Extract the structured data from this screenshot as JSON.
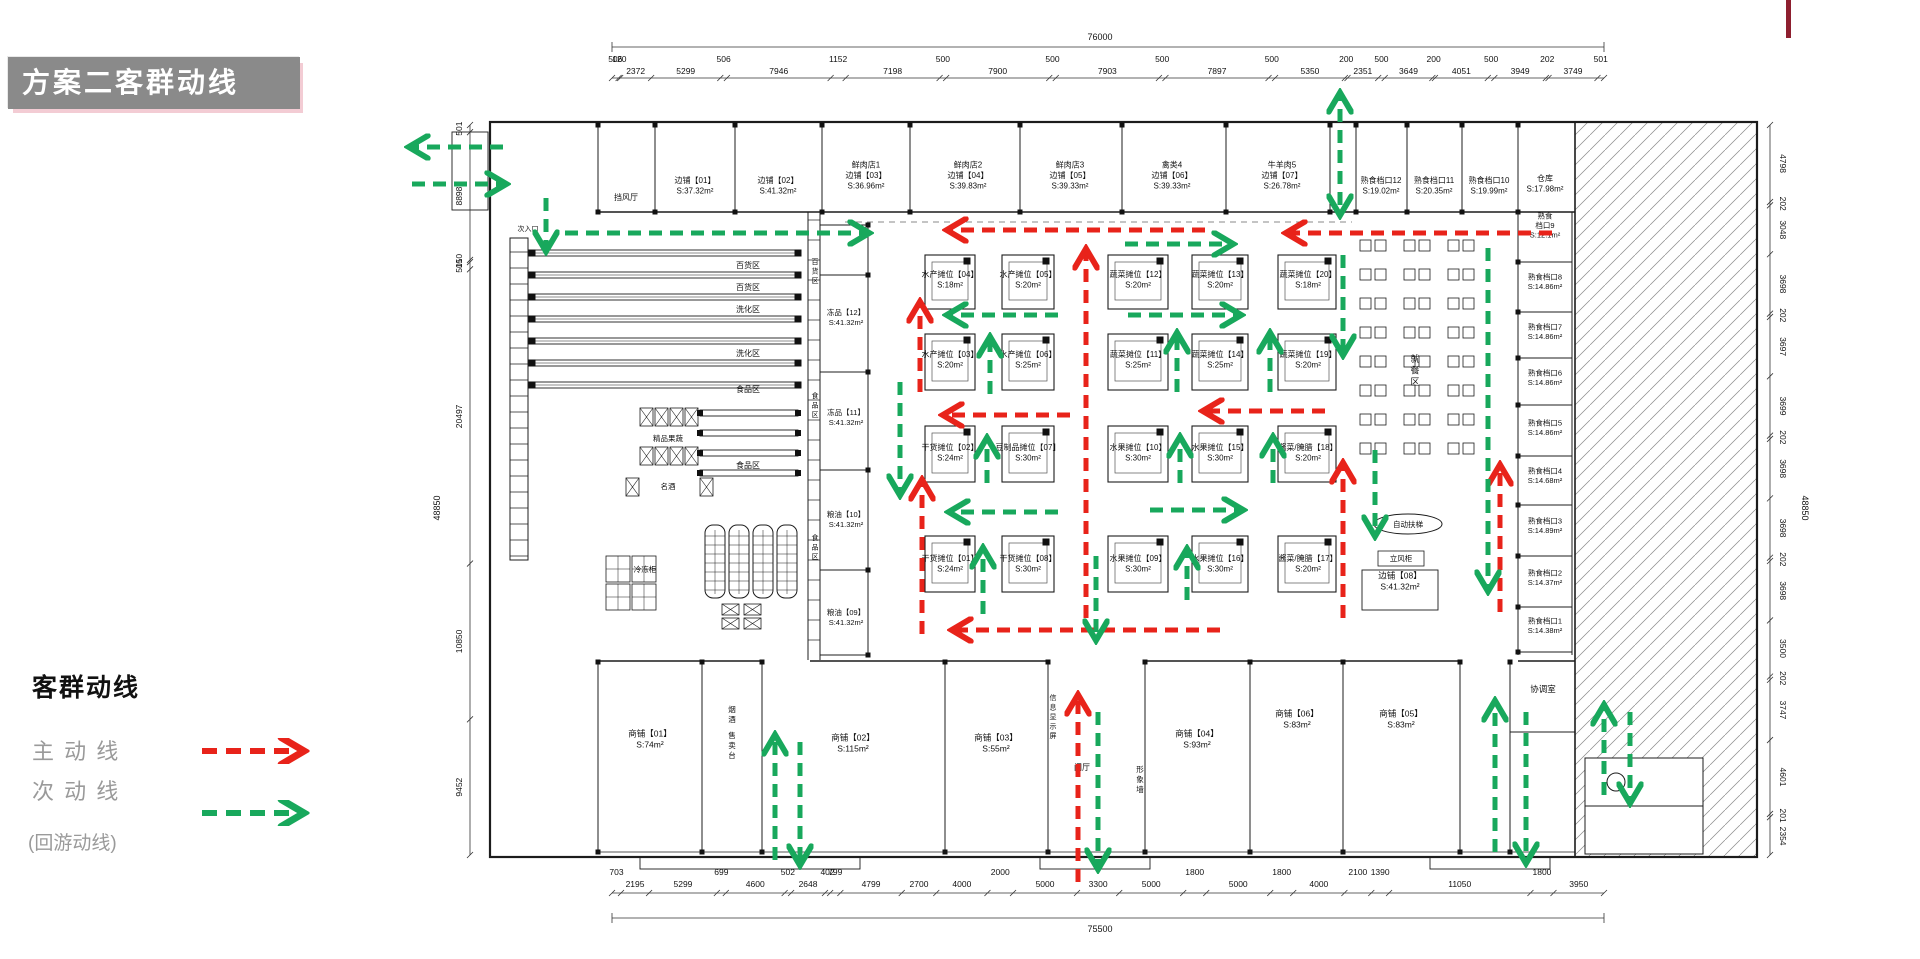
{
  "page": {
    "title": "方案二客群动线",
    "accent_red": "#e8231a",
    "accent_green": "#18a85c",
    "corner_mark_color": "#8e1f2f"
  },
  "legend": {
    "heading": "客群动线",
    "main_label": "主 动 线",
    "secondary_label": "次 动 线",
    "note_label": "(回游动线)"
  },
  "dimensions": {
    "top": {
      "total": "76000",
      "segments": [
        "506",
        "120",
        "2372",
        "5299",
        "506",
        "7946",
        "1152",
        "7198",
        "500",
        "7900",
        "500",
        "7903",
        "500",
        "7897",
        "500",
        "5350",
        "200",
        "2351",
        "500",
        "3649",
        "200",
        "4051",
        "500",
        "3949",
        "202",
        "3749",
        "501"
      ]
    },
    "bottom": {
      "total": "75500",
      "segments": [
        "703",
        "2195",
        "5299",
        "699",
        "4600",
        "502",
        "2648",
        "402",
        "799",
        "4799",
        "2700",
        "4000",
        "2000",
        "5000",
        "3300",
        "5000",
        "1800",
        "5000",
        "1800",
        "4000",
        "2100",
        "1390",
        "11050",
        "1800",
        "3950"
      ]
    },
    "left": {
      "total": "48850",
      "segments": [
        "501",
        "8898",
        "150",
        "501",
        "20497",
        "10850",
        "9452"
      ]
    },
    "right": {
      "total": "48850",
      "segments": [
        "4798",
        "202",
        "3048",
        "3698",
        "202",
        "3697",
        "3699",
        "202",
        "3698",
        "3698",
        "202",
        "3698",
        "3500",
        "202",
        "3747",
        "4601",
        "201",
        "2354"
      ]
    }
  },
  "plan": {
    "top_row": [
      {
        "lines": [
          "边铺【01】",
          "S:37.32m²"
        ],
        "cx": 695,
        "cy": 188
      },
      {
        "lines": [
          "边铺【02】",
          "S:41.32m²"
        ],
        "cx": 778,
        "cy": 188
      },
      {
        "lines": [
          "鲜肉店1",
          "边铺【03】",
          "S:36.96m²"
        ],
        "cx": 866,
        "cy": 178
      },
      {
        "lines": [
          "鲜肉店2",
          "边铺【04】",
          "S:39.83m²"
        ],
        "cx": 968,
        "cy": 178
      },
      {
        "lines": [
          "鲜肉店3",
          "边铺【05】",
          "S:39.33m²"
        ],
        "cx": 1070,
        "cy": 178
      },
      {
        "lines": [
          "禽类4",
          "边铺【06】",
          "S:39.33m²"
        ],
        "cx": 1172,
        "cy": 178
      },
      {
        "lines": [
          "牛羊肉5",
          "边铺【07】",
          "S:26.78m²"
        ],
        "cx": 1282,
        "cy": 178
      },
      {
        "lines": [
          "熟食档口12",
          "S:19.02m²"
        ],
        "cx": 1381,
        "cy": 188
      },
      {
        "lines": [
          "熟食档口11",
          "S:20.35m²"
        ],
        "cx": 1434,
        "cy": 188
      },
      {
        "lines": [
          "熟食档口10",
          "S:19.99m²"
        ],
        "cx": 1489,
        "cy": 188
      },
      {
        "lines": [
          "仓库",
          "S:17.98m²"
        ],
        "cx": 1545,
        "cy": 186
      }
    ],
    "right_column": [
      {
        "lines": [
          "熟食",
          "档口9",
          "S:12.1m²"
        ],
        "cx": 1545,
        "cy": 228
      },
      {
        "lines": [
          "熟食档口8",
          "S:14.86m²"
        ],
        "cx": 1545,
        "cy": 284
      },
      {
        "lines": [
          "熟食档口7",
          "S:14.86m²"
        ],
        "cx": 1545,
        "cy": 334
      },
      {
        "lines": [
          "熟食档口6",
          "S:14.86m²"
        ],
        "cx": 1545,
        "cy": 380
      },
      {
        "lines": [
          "熟食档口5",
          "S:14.86m²"
        ],
        "cx": 1545,
        "cy": 430
      },
      {
        "lines": [
          "熟食档口4",
          "S:14.68m²"
        ],
        "cx": 1545,
        "cy": 478
      },
      {
        "lines": [
          "熟食档口3",
          "S:14.89m²"
        ],
        "cx": 1545,
        "cy": 528
      },
      {
        "lines": [
          "熟食档口2",
          "S:14.37m²"
        ],
        "cx": 1545,
        "cy": 580
      },
      {
        "lines": [
          "熟食档口1",
          "S:14.38m²"
        ],
        "cx": 1545,
        "cy": 628
      }
    ],
    "side_column": [
      {
        "lines": [
          "冻品【12】",
          "S:41.32m²"
        ],
        "cx": 846,
        "cy": 320
      },
      {
        "lines": [
          "冻品【11】",
          "S:41.32m²"
        ],
        "cx": 846,
        "cy": 420
      },
      {
        "lines": [
          "粮油【10】",
          "S:41.32m²"
        ],
        "cx": 846,
        "cy": 522
      },
      {
        "lines": [
          "粮油【09】",
          "S:41.32m²"
        ],
        "cx": 846,
        "cy": 620
      }
    ],
    "stalls": [
      {
        "lines": [
          "水产摊位【04】",
          "S:18m²"
        ],
        "cx": 950,
        "cy": 282
      },
      {
        "lines": [
          "水产摊位【05】",
          "S:20m²"
        ],
        "cx": 1028,
        "cy": 282
      },
      {
        "lines": [
          "蔬菜摊位【12】",
          "S:20m²"
        ],
        "cx": 1138,
        "cy": 282
      },
      {
        "lines": [
          "蔬菜摊位【13】",
          "S:20m²"
        ],
        "cx": 1220,
        "cy": 282
      },
      {
        "lines": [
          "蔬菜摊位【20】",
          "S:18m²"
        ],
        "cx": 1308,
        "cy": 282
      },
      {
        "lines": [
          "水产摊位【03】",
          "S:20m²"
        ],
        "cx": 950,
        "cy": 362
      },
      {
        "lines": [
          "水产摊位【06】",
          "S:25m²"
        ],
        "cx": 1028,
        "cy": 362
      },
      {
        "lines": [
          "蔬菜摊位【11】",
          "S:25m²"
        ],
        "cx": 1138,
        "cy": 362
      },
      {
        "lines": [
          "蔬菜摊位【14】",
          "S:25m²"
        ],
        "cx": 1220,
        "cy": 362
      },
      {
        "lines": [
          "蔬菜摊位【19】",
          "S:20m²"
        ],
        "cx": 1308,
        "cy": 362
      },
      {
        "lines": [
          "干货摊位【02】",
          "S:24m²"
        ],
        "cx": 950,
        "cy": 455
      },
      {
        "lines": [
          "豆制品摊位【07】",
          "S:30m²"
        ],
        "cx": 1028,
        "cy": 455
      },
      {
        "lines": [
          "水果摊位【10】",
          "S:30m²"
        ],
        "cx": 1138,
        "cy": 455
      },
      {
        "lines": [
          "水果摊位【15】",
          "S:30m²"
        ],
        "cx": 1220,
        "cy": 455
      },
      {
        "lines": [
          "酱菜/腌腊【18】",
          "S:20m²"
        ],
        "cx": 1308,
        "cy": 455
      },
      {
        "lines": [
          "干货摊位【01】",
          "S:24m²"
        ],
        "cx": 950,
        "cy": 566
      },
      {
        "lines": [
          "干货摊位【08】",
          "S:30m²"
        ],
        "cx": 1028,
        "cy": 566
      },
      {
        "lines": [
          "水果摊位【09】",
          "S:30m²"
        ],
        "cx": 1138,
        "cy": 566
      },
      {
        "lines": [
          "水果摊位【16】",
          "S:30m²"
        ],
        "cx": 1220,
        "cy": 566
      },
      {
        "lines": [
          "酱菜/腌腊【17】",
          "S:20m²"
        ],
        "cx": 1308,
        "cy": 566
      }
    ],
    "bottom_row": [
      {
        "lines": [
          "商铺【01】",
          "S:74m²"
        ],
        "cx": 650,
        "cy": 742
      },
      {
        "lines": [
          "商铺【02】",
          "S:115m²"
        ],
        "cx": 853,
        "cy": 746
      },
      {
        "lines": [
          "商铺【03】",
          "S:55m²"
        ],
        "cx": 996,
        "cy": 746
      },
      {
        "lines": [
          "商铺【04】",
          "S:93m²"
        ],
        "cx": 1197,
        "cy": 742
      },
      {
        "lines": [
          "商铺【06】",
          "S:83m²"
        ],
        "cx": 1297,
        "cy": 722
      },
      {
        "lines": [
          "商铺【05】",
          "S:83m²"
        ],
        "cx": 1401,
        "cy": 722
      },
      {
        "lines": [
          "协调室"
        ],
        "cx": 1543,
        "cy": 692
      },
      {
        "lines": [
          "边铺【08】",
          "S:41.32m²"
        ],
        "cx": 1400,
        "cy": 584
      }
    ],
    "area_labels": [
      {
        "t": "挡风厅",
        "x": 626,
        "y": 200,
        "fs": 8
      },
      {
        "t": "次入口",
        "x": 528,
        "y": 231,
        "fs": 7
      },
      {
        "t": "百货区",
        "x": 748,
        "y": 268,
        "fs": 8
      },
      {
        "t": "百货区",
        "x": 748,
        "y": 290,
        "fs": 8
      },
      {
        "t": "洗化区",
        "x": 748,
        "y": 312,
        "fs": 8
      },
      {
        "t": "洗化区",
        "x": 748,
        "y": 356,
        "fs": 8
      },
      {
        "t": "食品区",
        "x": 748,
        "y": 392,
        "fs": 8
      },
      {
        "t": "食品区",
        "x": 748,
        "y": 468,
        "fs": 8
      },
      {
        "t": "百货区",
        "x": 815,
        "y": 264,
        "fs": 7,
        "v": true
      },
      {
        "t": "食品区",
        "x": 815,
        "y": 398,
        "fs": 7,
        "v": true
      },
      {
        "t": "食品区",
        "x": 815,
        "y": 540,
        "fs": 7,
        "v": true
      },
      {
        "t": "精品果蔬",
        "x": 668,
        "y": 441,
        "fs": 7.5
      },
      {
        "t": "名酒",
        "x": 668,
        "y": 489,
        "fs": 7.5
      },
      {
        "t": "冷冻柜",
        "x": 645,
        "y": 572,
        "fs": 7.5
      },
      {
        "t": "就餐区",
        "x": 1415,
        "y": 362,
        "fs": 9,
        "v": true
      },
      {
        "t": "自动扶梯",
        "x": 1408,
        "y": 527,
        "fs": 7.5
      },
      {
        "t": "立风柜",
        "x": 1401,
        "y": 561,
        "fs": 7.5
      },
      {
        "t": "烟酒",
        "x": 732,
        "y": 712,
        "fs": 7.5,
        "v": true
      },
      {
        "t": "售卖台",
        "x": 732,
        "y": 738,
        "fs": 7.5,
        "v": true
      },
      {
        "t": "信息显示屏",
        "x": 1053,
        "y": 700,
        "fs": 7,
        "v": true
      },
      {
        "t": "门厅",
        "x": 1082,
        "y": 770,
        "fs": 8
      },
      {
        "t": "形象墙",
        "x": 1140,
        "y": 772,
        "fs": 7.5,
        "v": true
      }
    ],
    "flow_main": [
      [
        1205,
        230,
        950,
        230
      ],
      [
        1552,
        233,
        1289,
        233
      ],
      [
        920,
        392,
        920,
        305
      ],
      [
        922,
        634,
        922,
        483
      ],
      [
        1070,
        415,
        946,
        415
      ],
      [
        1325,
        411,
        1206,
        411
      ],
      [
        1086,
        618,
        1086,
        252
      ],
      [
        1220,
        630,
        955,
        630
      ],
      [
        1343,
        618,
        1343,
        466
      ],
      [
        1500,
        612,
        1500,
        468
      ],
      [
        1078,
        882,
        1078,
        698
      ]
    ],
    "flow_secondary": [
      [
        503,
        147,
        412,
        147
      ],
      [
        412,
        184,
        503,
        184
      ],
      [
        546,
        198,
        546,
        248
      ],
      [
        565,
        233,
        866,
        233
      ],
      [
        1125,
        244,
        1230,
        244
      ],
      [
        1340,
        143,
        1340,
        96
      ],
      [
        1340,
        150,
        1340,
        212
      ],
      [
        1058,
        315,
        950,
        315
      ],
      [
        1128,
        315,
        1238,
        315
      ],
      [
        990,
        394,
        990,
        340
      ],
      [
        1177,
        392,
        1177,
        336
      ],
      [
        1270,
        392,
        1270,
        336
      ],
      [
        1343,
        255,
        1343,
        352
      ],
      [
        900,
        382,
        900,
        492
      ],
      [
        987,
        483,
        987,
        441
      ],
      [
        1180,
        483,
        1180,
        440
      ],
      [
        1273,
        483,
        1273,
        440
      ],
      [
        1058,
        512,
        952,
        512
      ],
      [
        1150,
        510,
        1240,
        510
      ],
      [
        1375,
        450,
        1375,
        533
      ],
      [
        983,
        614,
        983,
        551
      ],
      [
        1187,
        600,
        1187,
        552
      ],
      [
        1096,
        556,
        1096,
        637
      ],
      [
        775,
        860,
        775,
        738
      ],
      [
        800,
        742,
        800,
        862
      ],
      [
        1098,
        712,
        1098,
        866
      ],
      [
        1495,
        852,
        1495,
        704
      ],
      [
        1526,
        712,
        1526,
        860
      ],
      [
        1488,
        248,
        1488,
        588
      ],
      [
        1604,
        795,
        1604,
        708
      ],
      [
        1630,
        712,
        1630,
        800
      ]
    ]
  }
}
